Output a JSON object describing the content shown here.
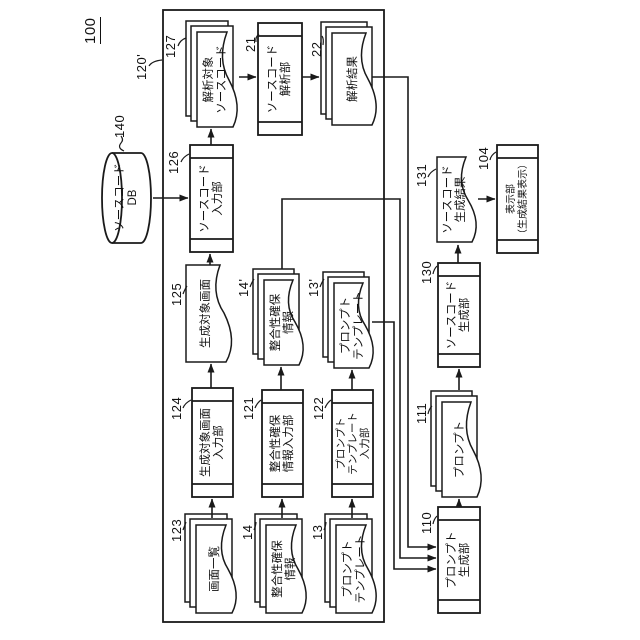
{
  "figure": {
    "number": "100",
    "outer_group_ref": "120'"
  },
  "nodes": {
    "db140": {
      "ref": "140",
      "label": "ソースコード\nDB"
    },
    "stack123": {
      "ref": "123",
      "label": "画面一覧"
    },
    "box124": {
      "ref": "124",
      "label": "生成対象画面\n入力部"
    },
    "doc125": {
      "ref": "125",
      "label": "生成対象画面"
    },
    "box126": {
      "ref": "126",
      "label": "ソースコード\n入力部"
    },
    "stack127": {
      "ref": "127",
      "label": "解析対象\nソースコード"
    },
    "box21": {
      "ref": "21",
      "label": "ソースコード\n解析部"
    },
    "stack22": {
      "ref": "22",
      "label": "解析結果"
    },
    "stack14": {
      "ref": "14",
      "label": "整合性確保\n情報"
    },
    "box121": {
      "ref": "121",
      "label": "整合性確保\n情報入力部"
    },
    "stack14p": {
      "ref": "14'",
      "label": "整合性確保\n情報"
    },
    "stack13": {
      "ref": "13",
      "label": "プロンプト\nテンプレート"
    },
    "box122": {
      "ref": "122",
      "label": "プロンプト\nテンプレート\n入力部"
    },
    "stack13p": {
      "ref": "13'",
      "label": "プロンプト\nテンプレート"
    },
    "box110": {
      "ref": "110",
      "label": "プロンプト\n生成部"
    },
    "stack111": {
      "ref": "111",
      "label": "プロンプト"
    },
    "box130": {
      "ref": "130",
      "label": "ソースコード\n生成部"
    },
    "doc131": {
      "ref": "131",
      "label": "ソースコード\n生成結果"
    },
    "box104": {
      "ref": "104",
      "label": "表示部\n（生成結果表示）"
    }
  },
  "colors": {
    "line": "#1a1a1a",
    "background": "#ffffff"
  }
}
